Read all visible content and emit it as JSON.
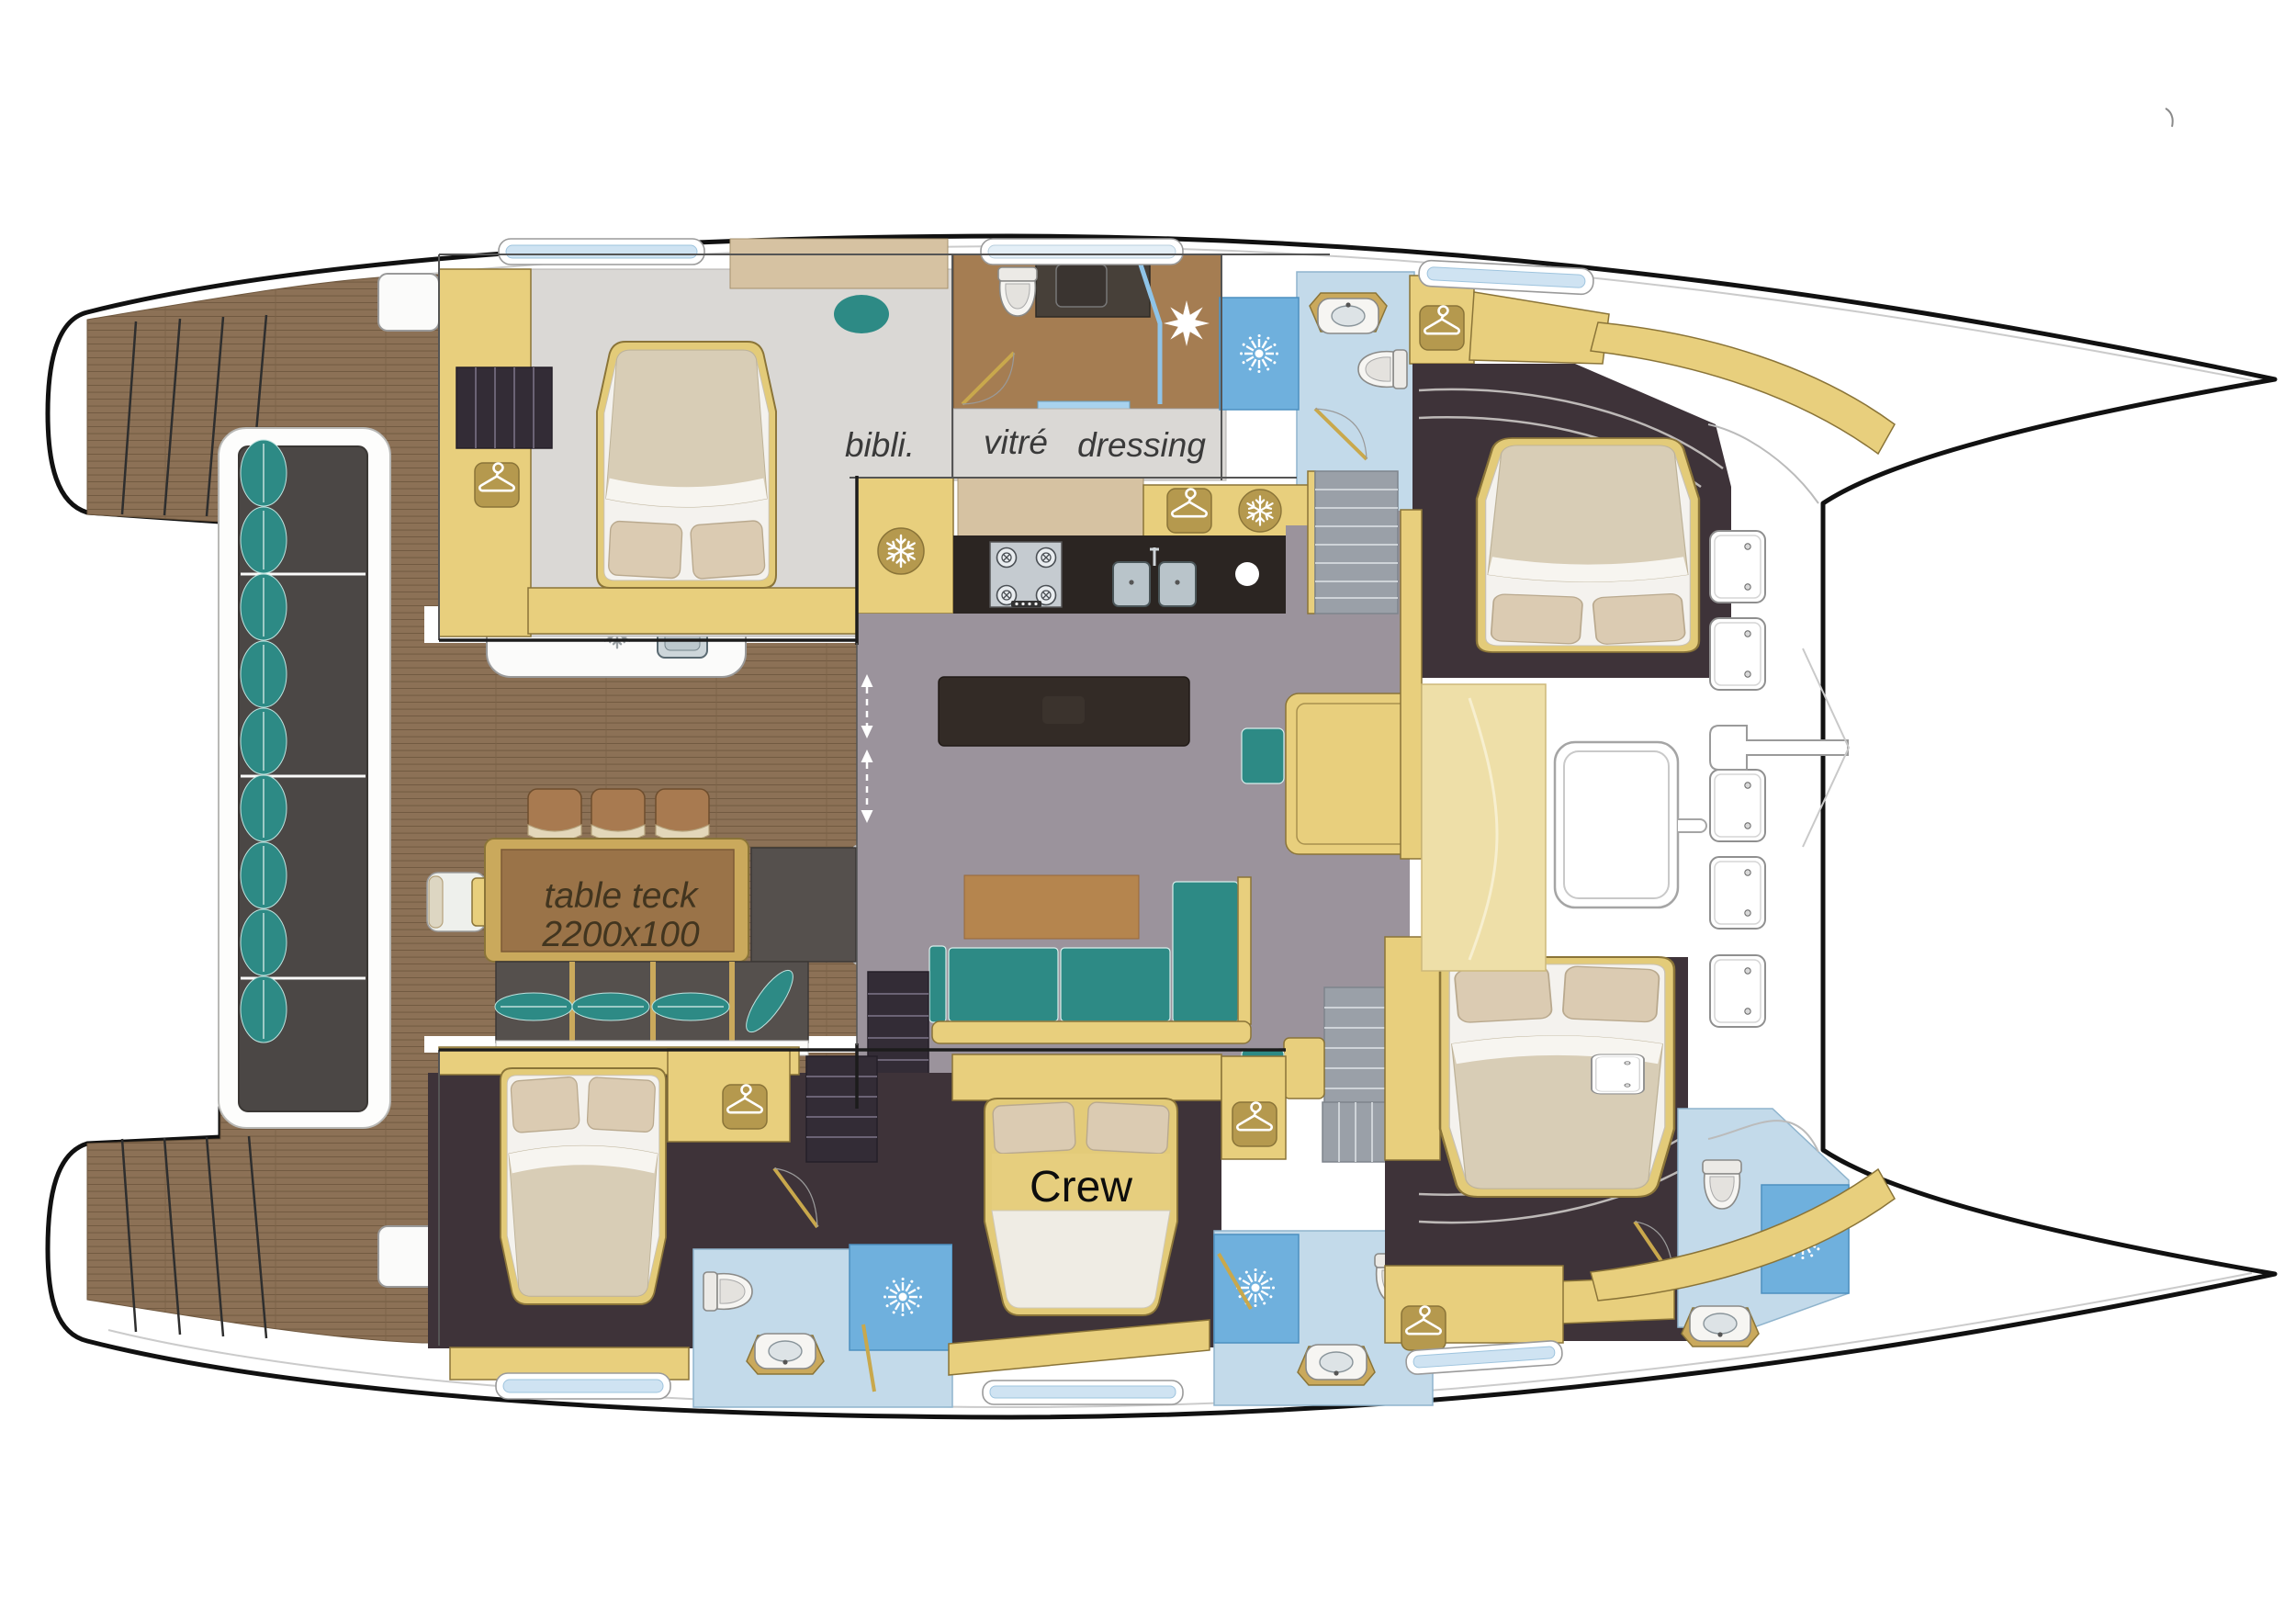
{
  "page": {
    "type": "catamaran-interior-deck-plan",
    "background": "#ffffff"
  },
  "labels": {
    "library": "bibli.",
    "glazing": "vitré",
    "dressing": "dressing",
    "table_line1": "table teck",
    "table_line2": "2200x100",
    "crew": "Crew"
  },
  "colors": {
    "hull_outline": "#111111",
    "teak_deck": "#8c7156",
    "teak_plank_line": "#6e573e",
    "cabinet_gold": "#e8cf7d",
    "icon_plate_gold": "#b5994e",
    "cabinet_beige": "#d6c2a2",
    "salon_floor_gray": "#9b939c",
    "cabin_floor_light": "#dad8d5",
    "cabin_floor_dark": "#3e3339",
    "bathroom_blue": "#c3daea",
    "shower_blue": "#6fb0dd",
    "upholstery_teal": "#2d8a85",
    "galley_counter_dark": "#2b2522",
    "table_teak_top": "#9a7348",
    "bedding_cream": "#efece4"
  },
  "icons": {
    "wardrobe": "hanger-icon",
    "fridge": "snowflake-icon",
    "shower": "shower-sunburst-icon",
    "shower_alt": "shower-star-icon",
    "wc": "toilet-icon",
    "washbasin": "sink-icon",
    "cooktop": "stove-burner-icon",
    "deck_hatch": "deck-hatch-icon",
    "sliding_door": "double-arrow-icon"
  }
}
